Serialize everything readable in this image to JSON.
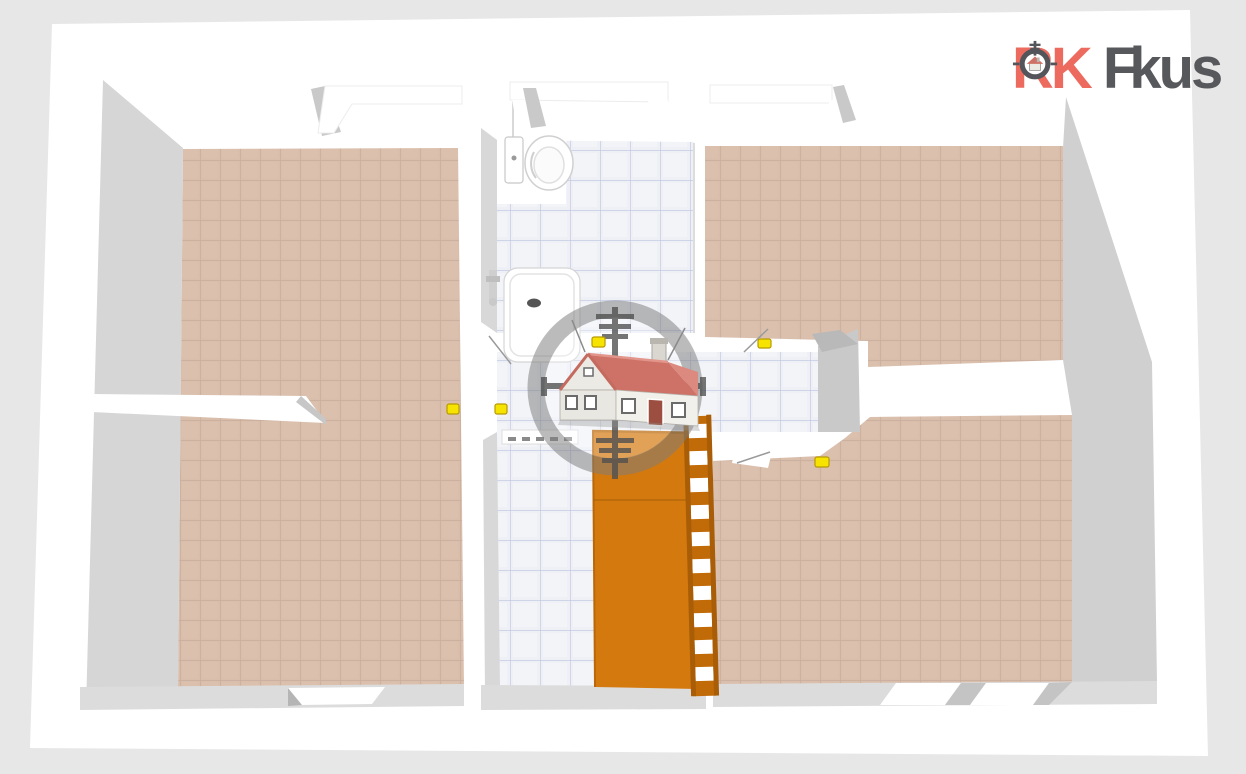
{
  "logo": {
    "brand_primary": "RK",
    "brand_secondary_initial": "F",
    "brand_secondary_rest": "kus"
  },
  "watermark": {
    "description": "scope-crosshair-with-house-logo"
  },
  "colors": {
    "background": "#e7e7e7",
    "canvas_white": "#ffffff",
    "wall_shadow": "#d6d6d6",
    "wall_shadow_dark": "#c9c9c9",
    "floor_tile_tan": "#d9beac",
    "floor_tile_tan_grout": "#c9ad9c",
    "bathroom_tile": "#eef0f6",
    "bathroom_tile_grout": "#aab6d6",
    "staircase_orange": "#d4790e",
    "staircase_orange_dark": "#b96708",
    "door_handle_yellow": "#f6e400",
    "door_handle_edge": "#b89a00",
    "watermark_gray": "#7d7d7d",
    "house_roof_red": "#ce7166",
    "logo_red": "#ed6a5e",
    "logo_gray": "#57585c"
  }
}
